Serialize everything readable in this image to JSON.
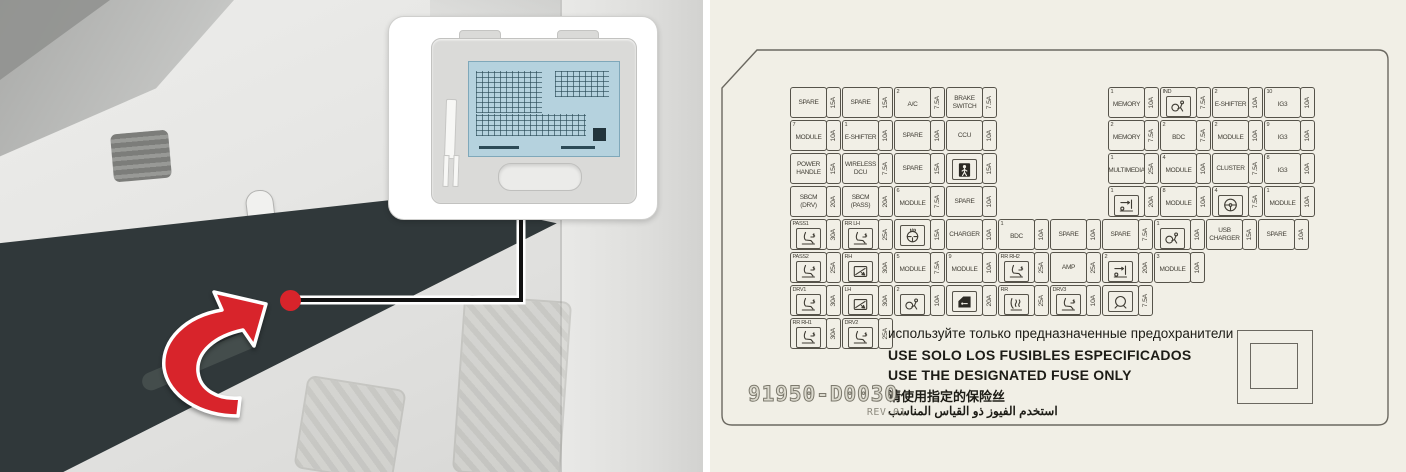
{
  "colors": {
    "accent_red": "#d8242b",
    "panel_cream": "#f1efe6",
    "mini_label_blue": "#b5d2de",
    "dark_panel": "#30383a"
  },
  "left_photo": {
    "elements": [
      "instrument-panel-photo",
      "fuse-panel-cover-dark",
      "location-red-dot",
      "callout-fuse-cover",
      "red-curved-arrow"
    ]
  },
  "fuse_panel": {
    "part_number": "91950-D0030",
    "revision": "REV.01",
    "warnings": {
      "ru": "используйте только предназначенные предохранители",
      "es": "USE SOLO LOS FUSIBLES ESPECIFICADOS",
      "en": "USE THE DESIGNATED FUSE ONLY",
      "zh": "请使用指定的保险丝",
      "ar": "استخدم الفيوز ذو القياس المناسب"
    },
    "rows": [
      {
        "y": 87,
        "segments": [
          {
            "x": 80,
            "cells": [
              {
                "label": "SPARE",
                "amp": "15A"
              },
              {
                "label": "SPARE",
                "amp": "15A"
              },
              {
                "sup": "2",
                "label": "A/C",
                "amp": "7.5A"
              },
              {
                "label": "BRAKE SWITCH",
                "amp": "7.5A"
              }
            ]
          },
          {
            "x": 398,
            "cells": [
              {
                "sup": "1",
                "label": "MEMORY",
                "amp": "10A"
              },
              {
                "sup": "IND",
                "icon": "airbag-icon",
                "amp": "7.5A"
              },
              {
                "sup": "2",
                "label": "E-SHIFTER",
                "amp": "10A"
              },
              {
                "sup": "10",
                "label": "IG3",
                "amp": "10A"
              }
            ]
          }
        ]
      },
      {
        "y": 120,
        "segments": [
          {
            "x": 80,
            "cells": [
              {
                "sup": "7",
                "label": "MODULE",
                "amp": "10A"
              },
              {
                "sup": "1",
                "label": "E-SHIFTER",
                "amp": "10A"
              },
              {
                "label": "SPARE",
                "amp": "10A"
              },
              {
                "label": "CCU",
                "amp": "10A"
              }
            ]
          },
          {
            "x": 398,
            "cells": [
              {
                "sup": "2",
                "label": "MEMORY",
                "amp": "7.5A"
              },
              {
                "sup": "2",
                "label": "BDC",
                "amp": "7.5A"
              },
              {
                "sup": "2",
                "label": "MODULE",
                "amp": "10A"
              },
              {
                "sup": "9",
                "label": "IG3",
                "amp": "10A"
              }
            ]
          }
        ]
      },
      {
        "y": 153,
        "segments": [
          {
            "x": 80,
            "cells": [
              {
                "label": "POWER HANDLE",
                "amp": "15A"
              },
              {
                "label": "WIRELESS DCU",
                "amp": "7.5A"
              },
              {
                "label": "SPARE",
                "amp": "15A"
              },
              {
                "icon": "passenger-airbag-icon",
                "amp": "15A"
              }
            ]
          },
          {
            "x": 398,
            "cells": [
              {
                "sup": "1",
                "label": "MULTIMEDIA",
                "amp": "25A"
              },
              {
                "sup": "4",
                "label": "MODULE",
                "amp": "10A"
              },
              {
                "label": "CLUSTER",
                "amp": "7.5A"
              },
              {
                "sup": "8",
                "label": "IG3",
                "amp": "10A"
              }
            ]
          }
        ]
      },
      {
        "y": 186,
        "segments": [
          {
            "x": 80,
            "cells": [
              {
                "label": "SBCM (DRV)",
                "amp": "20A"
              },
              {
                "label": "SBCM (PASS)",
                "amp": "20A"
              },
              {
                "sup": "6",
                "label": "MODULE",
                "amp": "7.5A"
              },
              {
                "label": "SPARE",
                "amp": "10A"
              }
            ]
          },
          {
            "x": 398,
            "cells": [
              {
                "sup": "1",
                "icon": "seat-slide-icon",
                "amp": "20A"
              },
              {
                "sup": "8",
                "label": "MODULE",
                "amp": "10A"
              },
              {
                "sup": "4",
                "icon": "steering-wheel-icon",
                "amp": "7.5A"
              },
              {
                "sup": "1",
                "label": "MODULE",
                "amp": "10A"
              }
            ]
          }
        ]
      },
      {
        "y": 219,
        "segments": [
          {
            "x": 80,
            "cells": [
              {
                "sup": "PASS1",
                "icon": "power-seat-icon",
                "amp": "30A"
              },
              {
                "sup": "RR LH",
                "icon": "power-seat-icon",
                "amp": "25A"
              },
              {
                "icon": "heated-steering-wheel-icon",
                "amp": "15A"
              },
              {
                "label": "CHARGER",
                "amp": "10A"
              },
              {
                "sup": "1",
                "label": "BDC",
                "amp": "10A"
              },
              {
                "label": "SPARE",
                "amp": "10A"
              },
              {
                "label": "SPARE",
                "amp": "7.5A"
              },
              {
                "sup": "1",
                "icon": "airbag-icon",
                "amp": "10A"
              },
              {
                "label": "USB CHARGER",
                "amp": "15A"
              },
              {
                "label": "SPARE",
                "amp": "10A"
              }
            ]
          }
        ]
      },
      {
        "y": 252,
        "segments": [
          {
            "x": 80,
            "cells": [
              {
                "sup": "PASS2",
                "icon": "power-seat-icon",
                "amp": "25A"
              },
              {
                "sup": "RH",
                "icon": "power-window-icon",
                "amp": "30A"
              },
              {
                "sup": "5",
                "label": "MODULE",
                "amp": "7.5A"
              },
              {
                "sup": "9",
                "label": "MODULE",
                "amp": "10A"
              },
              {
                "sup": "RR RH2",
                "icon": "power-seat-icon",
                "amp": "25A"
              },
              {
                "label": "AMP",
                "amp": "25A"
              },
              {
                "sup": "2",
                "icon": "seat-slide-icon",
                "amp": "20A"
              },
              {
                "sup": "3",
                "label": "MODULE",
                "amp": "10A"
              }
            ]
          }
        ]
      },
      {
        "y": 285,
        "segments": [
          {
            "x": 80,
            "cells": [
              {
                "sup": "DRV1",
                "icon": "power-seat-icon",
                "amp": "30A"
              },
              {
                "sup": "LH",
                "icon": "power-window-icon",
                "amp": "30A"
              },
              {
                "sup": "2",
                "icon": "airbag-icon",
                "amp": "10A"
              },
              {
                "icon": "door-lock-icon",
                "amp": "20A"
              },
              {
                "sup": "RR",
                "icon": "heated-seat-icon",
                "amp": "25A"
              },
              {
                "sup": "DRV3",
                "icon": "power-seat-icon",
                "amp": "10A"
              },
              {
                "icon": "horn-icon",
                "amp": "7.5A"
              }
            ]
          }
        ]
      },
      {
        "y": 318,
        "segments": [
          {
            "x": 80,
            "cells": [
              {
                "sup": "RR RH1",
                "icon": "power-seat-icon",
                "amp": "30A"
              },
              {
                "sup": "DRV2",
                "icon": "power-seat-icon",
                "amp": "25A"
              }
            ]
          }
        ]
      }
    ]
  }
}
